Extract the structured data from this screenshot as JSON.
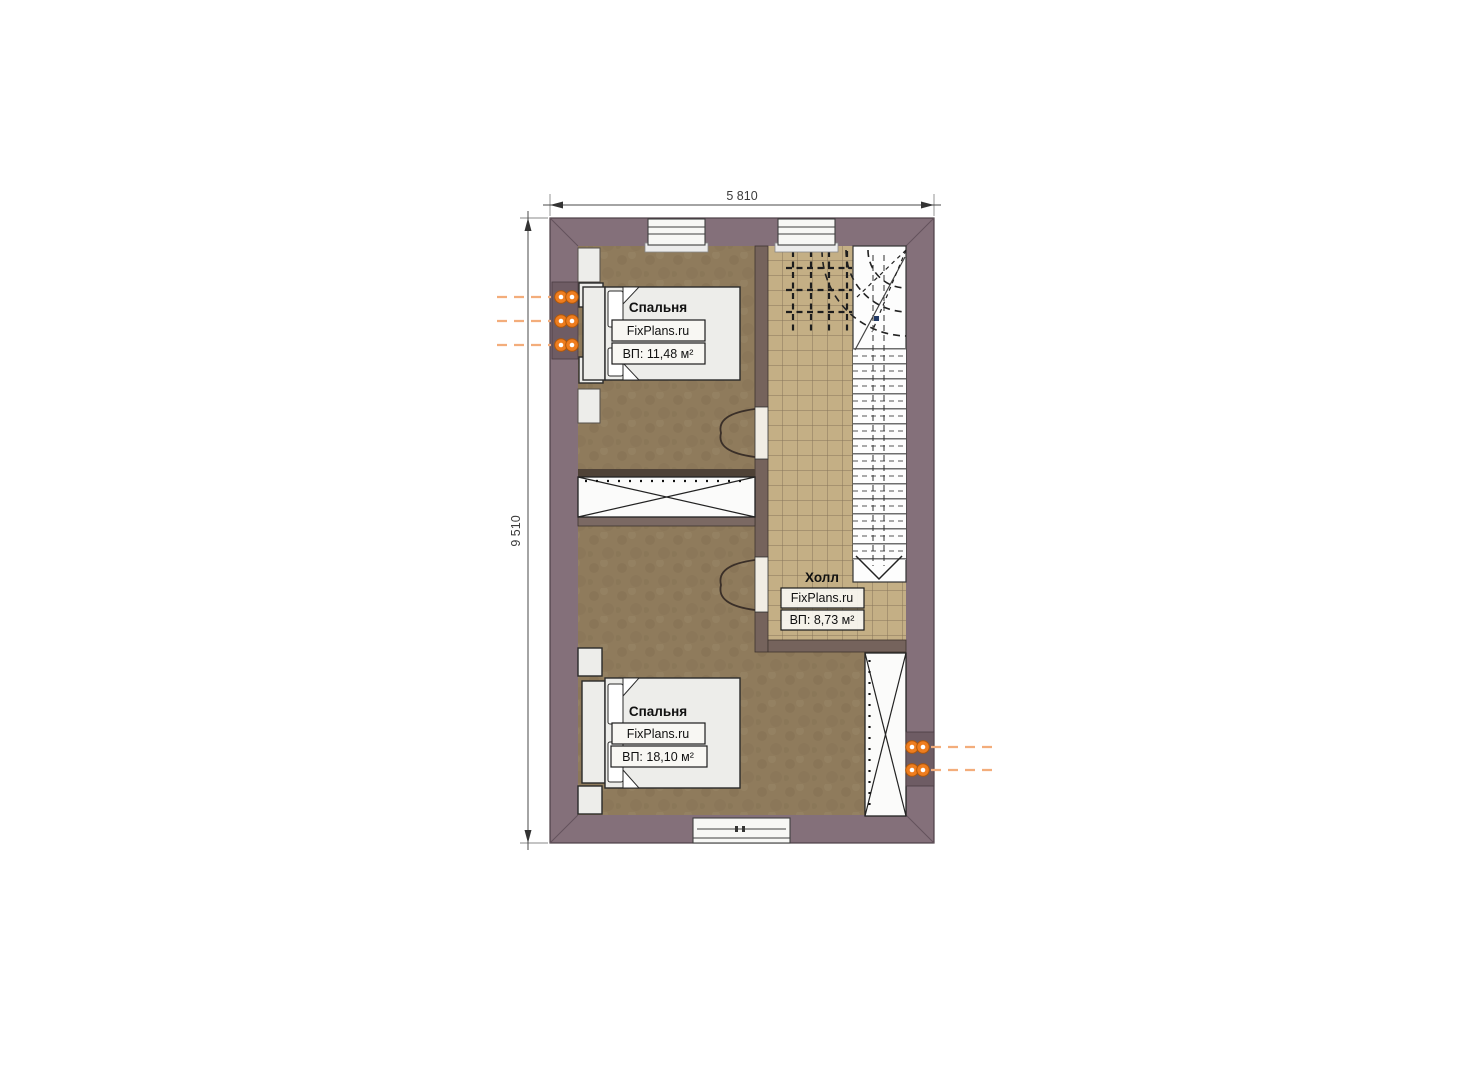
{
  "plan": {
    "dim_width": "5 810",
    "dim_height": "9 510",
    "rooms": [
      {
        "key": "bedroom-top",
        "name": "Спальня",
        "brand": "FixPlans.ru",
        "area": "ВП: 11,48 м²"
      },
      {
        "key": "hall",
        "name": "Холл",
        "brand": "FixPlans.ru",
        "area": "ВП: 8,73 м²"
      },
      {
        "key": "bedroom-bottom",
        "name": "Спальня",
        "brand": "FixPlans.ru",
        "area": "ВП: 18,10 м²"
      }
    ],
    "heating": {
      "left_radiator_count": 3,
      "right_radiator_count": 2
    },
    "colors": {
      "exterior_wall": "#84707a",
      "interior_wall": "#75635c",
      "bedroom_floor": "#8f7b5c",
      "hall_tile": "#c4af85",
      "tile_grid": "#87765a",
      "furniture": "#ededea",
      "outline": "#222222",
      "stair_bg": "#fdfdfd",
      "radiator": "#ee7d1f",
      "radiator_leader": "#f3ad7b",
      "dimension_text": "#3b3b3b"
    }
  }
}
